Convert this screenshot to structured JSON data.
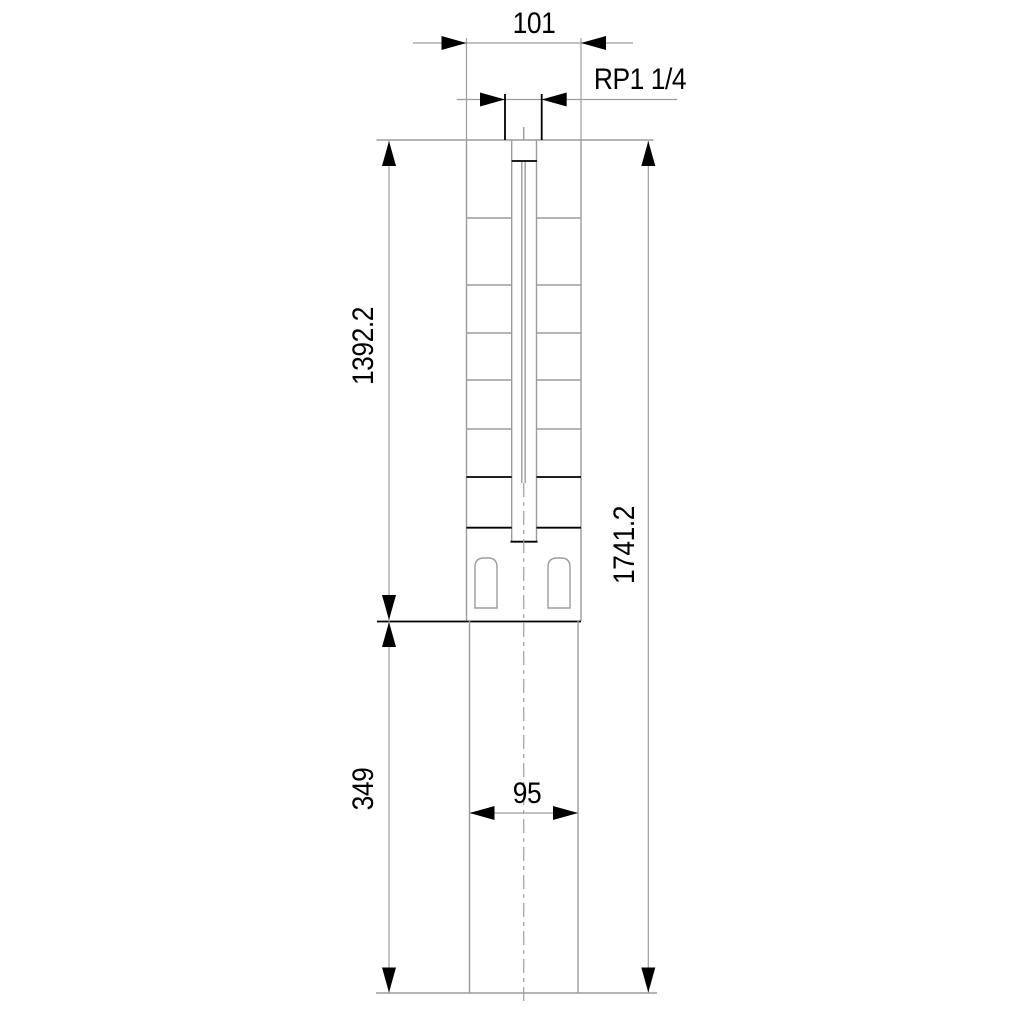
{
  "drawing": {
    "type": "technical-dimension-drawing",
    "subject": "submersible-pump-outline",
    "labels": {
      "top_width": "101",
      "thread": "RP1 1/4",
      "pump_length": "1392.2",
      "total_length": "1741.2",
      "motor_length": "349",
      "motor_width": "95"
    },
    "dimensions": [
      {
        "name": "pump-outer-width",
        "value": "101",
        "orientation": "horizontal"
      },
      {
        "name": "discharge-thread",
        "value": "RP1 1/4",
        "orientation": "horizontal"
      },
      {
        "name": "pump-section-length",
        "value": "1392.2",
        "orientation": "vertical"
      },
      {
        "name": "total-length",
        "value": "1741.2",
        "orientation": "vertical"
      },
      {
        "name": "motor-section-length",
        "value": "349",
        "orientation": "vertical"
      },
      {
        "name": "motor-width",
        "value": "95",
        "orientation": "horizontal"
      }
    ],
    "colors": {
      "background": "#ffffff",
      "outline": "#9c9c9c",
      "dimension_ink": "#000000"
    }
  }
}
